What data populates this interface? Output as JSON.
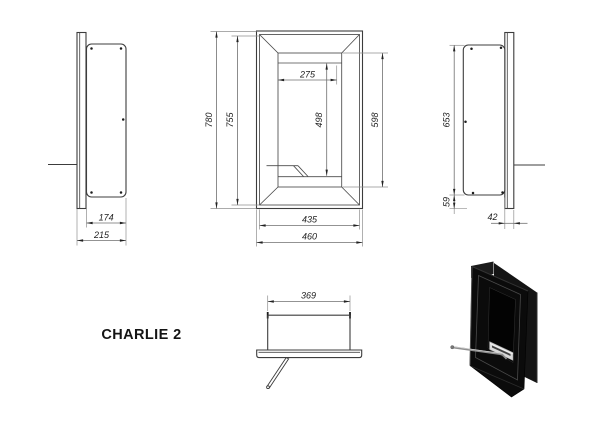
{
  "title": "CHARLIE 2",
  "views": {
    "left_side": {
      "name": "left side section view",
      "dims": {
        "recess_width": "174",
        "total_depth": "215"
      }
    },
    "front": {
      "name": "front view",
      "dims": {
        "total_height": "780",
        "frame_height": "755",
        "burner_width": "275",
        "opening_height": "498",
        "inner_height": "598",
        "frame_width": "435",
        "total_width": "460"
      }
    },
    "right_side": {
      "name": "right side section view",
      "dims": {
        "casing_height": "653",
        "bottom_offset": "59",
        "mount_depth": "42"
      }
    },
    "bottom": {
      "name": "bottom view",
      "dims": {
        "burner_length": "369"
      }
    }
  },
  "colors": {
    "drawing_line": "#3c3c3c",
    "dimension_line": "#6f6f6f",
    "text": "#222222",
    "render_black": "#0b0b0b",
    "burner_silver": "#d9d9d9"
  }
}
